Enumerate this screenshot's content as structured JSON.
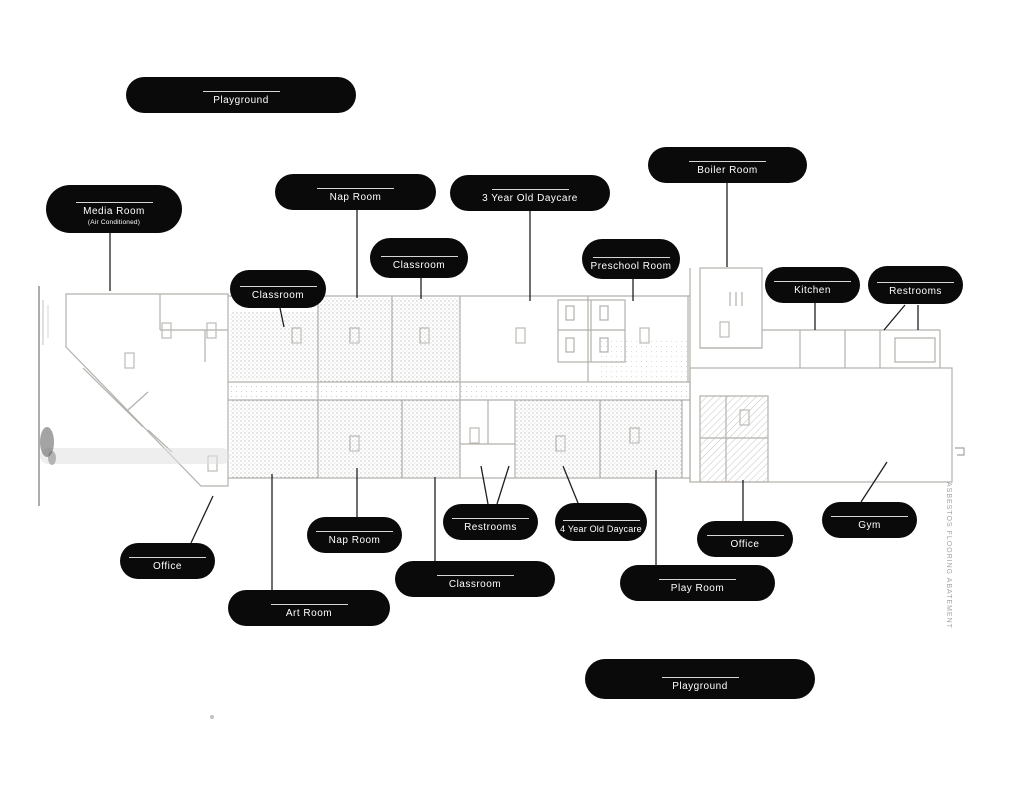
{
  "canvas": {
    "width": 1024,
    "height": 791,
    "background": "#ffffff"
  },
  "colors": {
    "pill_background": "#0a0a0a",
    "pill_text": "#ffffff",
    "pill_rule": "#d6d6d6",
    "leader_line": "#1f1f1f",
    "plan_line": "#b3b0ab",
    "plan_texture": "#8f8f8f"
  },
  "labels": [
    {
      "id": "playground-top",
      "text": "Playground"
    },
    {
      "id": "media-room",
      "text": "Media Room",
      "subtext": "(Air Conditioned)"
    },
    {
      "id": "nap-room-top",
      "text": "Nap Room"
    },
    {
      "id": "daycare-3yr",
      "text": "3 Year Old Daycare"
    },
    {
      "id": "boiler-room",
      "text": "Boiler Room"
    },
    {
      "id": "classroom-top-mid",
      "text": "Classroom"
    },
    {
      "id": "preschool-room",
      "text": "Preschool Room"
    },
    {
      "id": "classroom-top-left",
      "text": "Classroom"
    },
    {
      "id": "kitchen",
      "text": "Kitchen"
    },
    {
      "id": "restrooms-top",
      "text": "Restrooms"
    },
    {
      "id": "office-left",
      "text": "Office"
    },
    {
      "id": "nap-room-bottom",
      "text": "Nap Room"
    },
    {
      "id": "restrooms-bottom",
      "text": "Restrooms"
    },
    {
      "id": "daycare-4yr",
      "text": "4 Year Old Daycare"
    },
    {
      "id": "classroom-bottom",
      "text": "Classroom"
    },
    {
      "id": "art-room",
      "text": "Art Room"
    },
    {
      "id": "play-room",
      "text": "Play Room"
    },
    {
      "id": "office-right",
      "text": "Office"
    },
    {
      "id": "gym",
      "text": "Gym"
    },
    {
      "id": "playground-bottom",
      "text": "Playground"
    }
  ],
  "plan_note": {
    "vertical_text": "ASBESTOS FLOORING ABATEMENT"
  }
}
